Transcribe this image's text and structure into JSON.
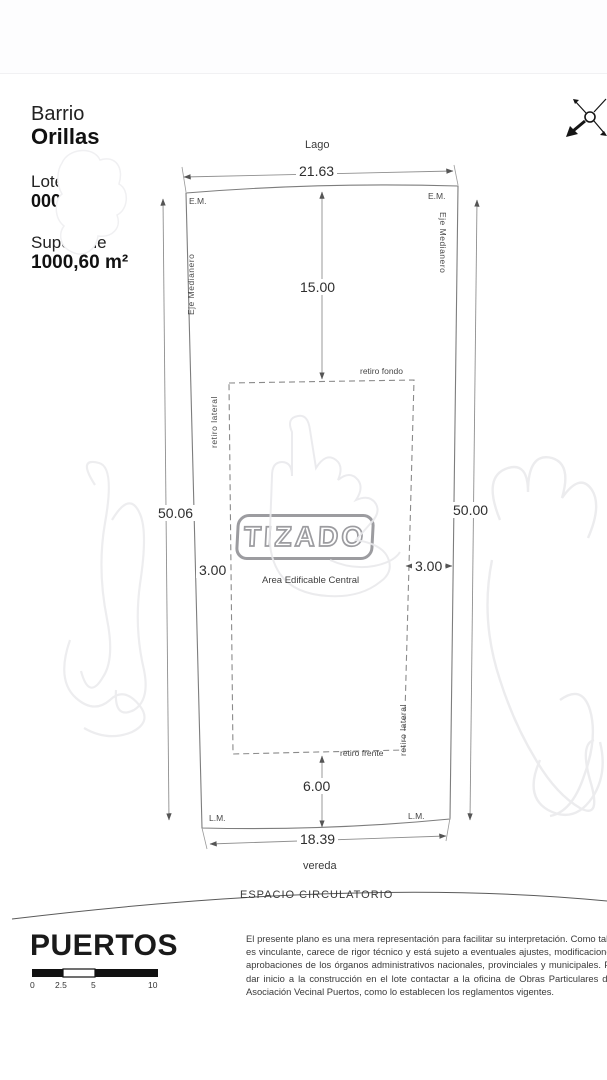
{
  "header": {
    "barrio_label": "Barrio",
    "barrio_name": "Orillas",
    "lote_label": "Lote",
    "lote_number": "0000",
    "superficie_label": "Superficie",
    "superficie_value": "1000,60 m²"
  },
  "plan": {
    "street_top": "Lago",
    "street_bottom": "vereda",
    "espacio_circulatorio": "ESPACIO CIRCULATORIO",
    "dims": {
      "front_top": "21.63",
      "front_bottom": "18.39",
      "side_left": "50.06",
      "side_right": "50.00",
      "depth_to_building": "15.00",
      "front_setback": "6.00",
      "lateral_left_setback": "3.00",
      "lateral_right_setback": "3.00"
    },
    "labels": {
      "em_left": "E.M.",
      "em_right": "E.M.",
      "lm_left": "L.M.",
      "lm_right": "L.M.",
      "eje_medianero_left": "Eje Medianero",
      "eje_medianero_right": "Eje Medianero",
      "retiro_fondo": "retiro fondo",
      "retiro_frente": "retiro frente",
      "retiro_lateral_left": "retiro lateral",
      "retiro_lateral_right": "retiro lateral",
      "area_edificable": "Area Edificable Central"
    },
    "watermark": "TIZADO"
  },
  "footer": {
    "brand": "PUERTOS",
    "scale_ticks": [
      "0",
      "2.5",
      "5",
      "10"
    ],
    "disclaimer": "El presente plano es una mera representación para facilitar su interpretación. Como tal, no es vinculante, carece de rigor técnico y está sujeto a eventuales ajustes, modificaciones y aprobaciones de los órganos administrativos nacionales, provinciales y municipales. Para dar inicio a la construcción en el lote contactar a la oficina de Obras Particulares de la Asociación Vecinal Puertos, como lo establecen los reglamentos vigentes."
  },
  "colors": {
    "line": "#7d7d7d",
    "dim_line": "#8f8f8f",
    "watermark_gray": "#9c9ca0",
    "ink": "#1a1a1a"
  }
}
